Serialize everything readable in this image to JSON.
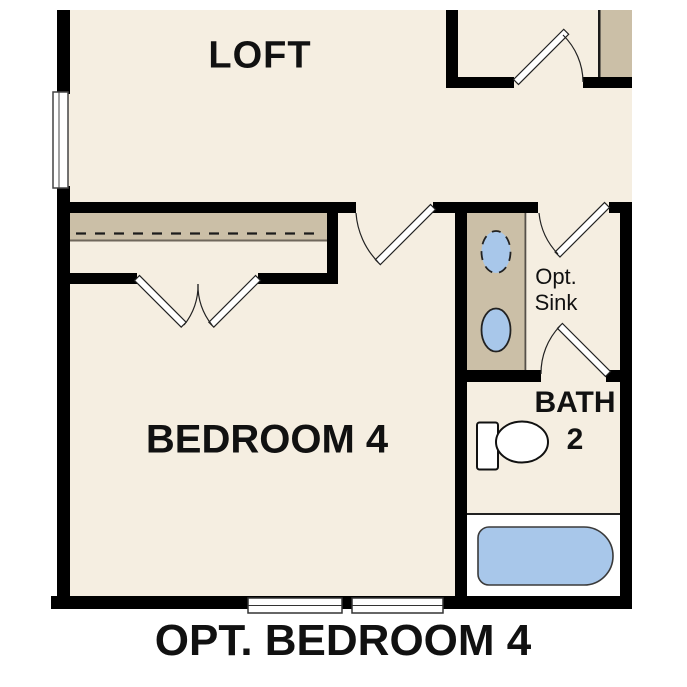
{
  "plan": {
    "labels": {
      "loft": "LOFT",
      "bedroom": "BEDROOM 4",
      "bath_line1": "BATH",
      "bath_line2": "2",
      "opt_sink_line1": "Opt.",
      "opt_sink_line2": "Sink",
      "caption": "OPT. BEDROOM 4"
    },
    "colors": {
      "floor": "#f5eee1",
      "cabinetry": "#cbbfa7",
      "fixture_blue": "#a8c7ea",
      "wall": "#000000",
      "tub_surround": "#ffffff"
    }
  }
}
